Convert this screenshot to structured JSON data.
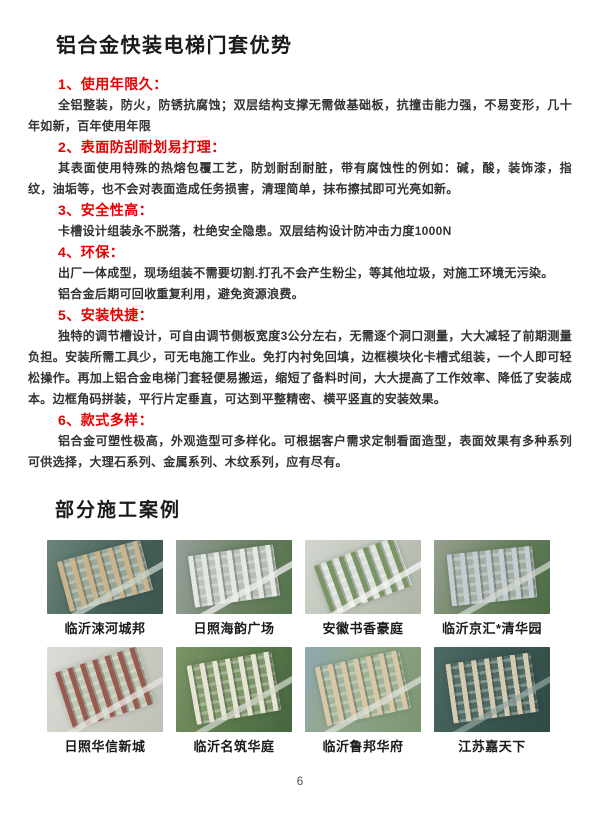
{
  "page": {
    "number": "6",
    "accent_red": "#e60000",
    "title_color": "#1a1a1a",
    "body_color": "#333333"
  },
  "advantages": {
    "title": "铝合金快装电梯门套优势",
    "items": [
      {
        "heading": "1、使用年限久：",
        "paragraphs": [
          "全铝整装，防火，防锈抗腐蚀；双层结构支撑无需做基础板，抗撞击能力强，不易变形，几十年如新，百年使用年限"
        ]
      },
      {
        "heading": "2、表面防刮耐划易打理：",
        "paragraphs": [
          "其表面使用特殊的热熔包覆工艺，防划耐刮耐脏，带有腐蚀性的例如：碱，酸，装饰漆，指纹，油垢等，也不会对表面造成任务损害，清理简单，抹布擦拭即可光亮如新。"
        ]
      },
      {
        "heading": "3、安全性高：",
        "paragraphs": [
          "卡槽设计组装永不脱落，杜绝安全隐患。双层结构设计防冲击力度1000N"
        ]
      },
      {
        "heading": "4、环保：",
        "paragraphs": [
          "出厂一体成型，现场组装不需要切割.打孔不会产生粉尘，等其他垃圾，对施工环境无污染。",
          "铝合金后期可回收重复利用，避免资源浪费。"
        ]
      },
      {
        "heading": "5、安装快捷：",
        "paragraphs": [
          "独特的调节槽设计，可自由调节侧板宽度3公分左右，无需逐个洞口测量，大大减轻了前期测量负担。安装所需工具少，可无电施工作业。免打内衬免回填，边框模块化卡槽式组装，一个人即可轻松操作。再加上铝合金电梯门套轻便易搬运，缩短了备料时间，大大提高了工作效率、降低了安装成本。边框角码拼装，平行片定垂直，可达到平整精密、横平竖直的安装效果。"
        ]
      },
      {
        "heading": "6、款式多样：",
        "paragraphs": [
          "铝合金可塑性极高，外观造型可多样化。可根据客户需求定制看面造型，表面效果有多种系列可供选择，大理石系列、金属系列、木纹系列，应有尽有。"
        ]
      }
    ]
  },
  "cases": {
    "title": "部分施工案例",
    "items": [
      {
        "caption": "临沂涑河城邦",
        "ground": "linear-gradient(115deg, #6b857a, #46605a 60%, #3c554e)",
        "pad": "rgba(172,182,164,0.8)",
        "buildings": "#c9b48d",
        "road": "rgba(208,216,206,0.85)",
        "tilt": -15
      },
      {
        "caption": "日照海韵广场",
        "ground": "linear-gradient(100deg, #95a09a, #6d8263 55%, #54744c)",
        "pad": "rgba(206,212,206,0.75)",
        "buildings": "#e4e7e3",
        "road": "rgba(236,238,235,0.9)",
        "tilt": -8
      },
      {
        "caption": "安徽书香豪庭",
        "ground": "linear-gradient(120deg, #d2d6cf, #bcc2b6 60%, #aeb6a8)",
        "pad": "rgba(228,230,224,0.8)",
        "buildings": "#7a9465",
        "road": "rgba(245,246,243,0.9)",
        "tilt": -20
      },
      {
        "caption": "临沂京汇*清华园",
        "ground": "linear-gradient(115deg, #97a090, #66805c 55%, #4c6a44)",
        "pad": "rgba(180,188,184,0.75)",
        "buildings": "#c6cdd2",
        "road": "rgba(214,218,212,0.85)",
        "tilt": -6
      },
      {
        "caption": "日照华信新城",
        "ground": "linear-gradient(115deg, #dcdcd6, #c9cac2 60%, #bfc1b9)",
        "pad": "rgba(188,196,172,0.8)",
        "buildings": "#9a5a50",
        "road": "rgba(228,228,222,0.9)",
        "tilt": -18
      },
      {
        "caption": "临沂名筑华庭",
        "ground": "linear-gradient(110deg, #7c9468, #5a7a4c 55%, #466540)",
        "pad": "rgba(142,162,118,0.7)",
        "buildings": "#e8e4d4",
        "road": "rgba(212,218,206,0.85)",
        "tilt": -10
      },
      {
        "caption": "临沂鲁邦华府",
        "ground": "linear-gradient(115deg, #8fa8b0, #93a88c 40%, #7a9472)",
        "pad": "rgba(168,184,156,0.75)",
        "buildings": "#d8c8a6",
        "road": "rgba(222,226,218,0.85)",
        "tilt": -12
      },
      {
        "caption": "江苏嘉天下",
        "ground": "linear-gradient(115deg, #4e6a64, #3a5650 55%, #2f4a44)",
        "pad": "rgba(90,116,108,0.7)",
        "buildings": "#d4cab2",
        "road": "rgba(150,168,162,0.8)",
        "tilt": -8
      }
    ]
  }
}
